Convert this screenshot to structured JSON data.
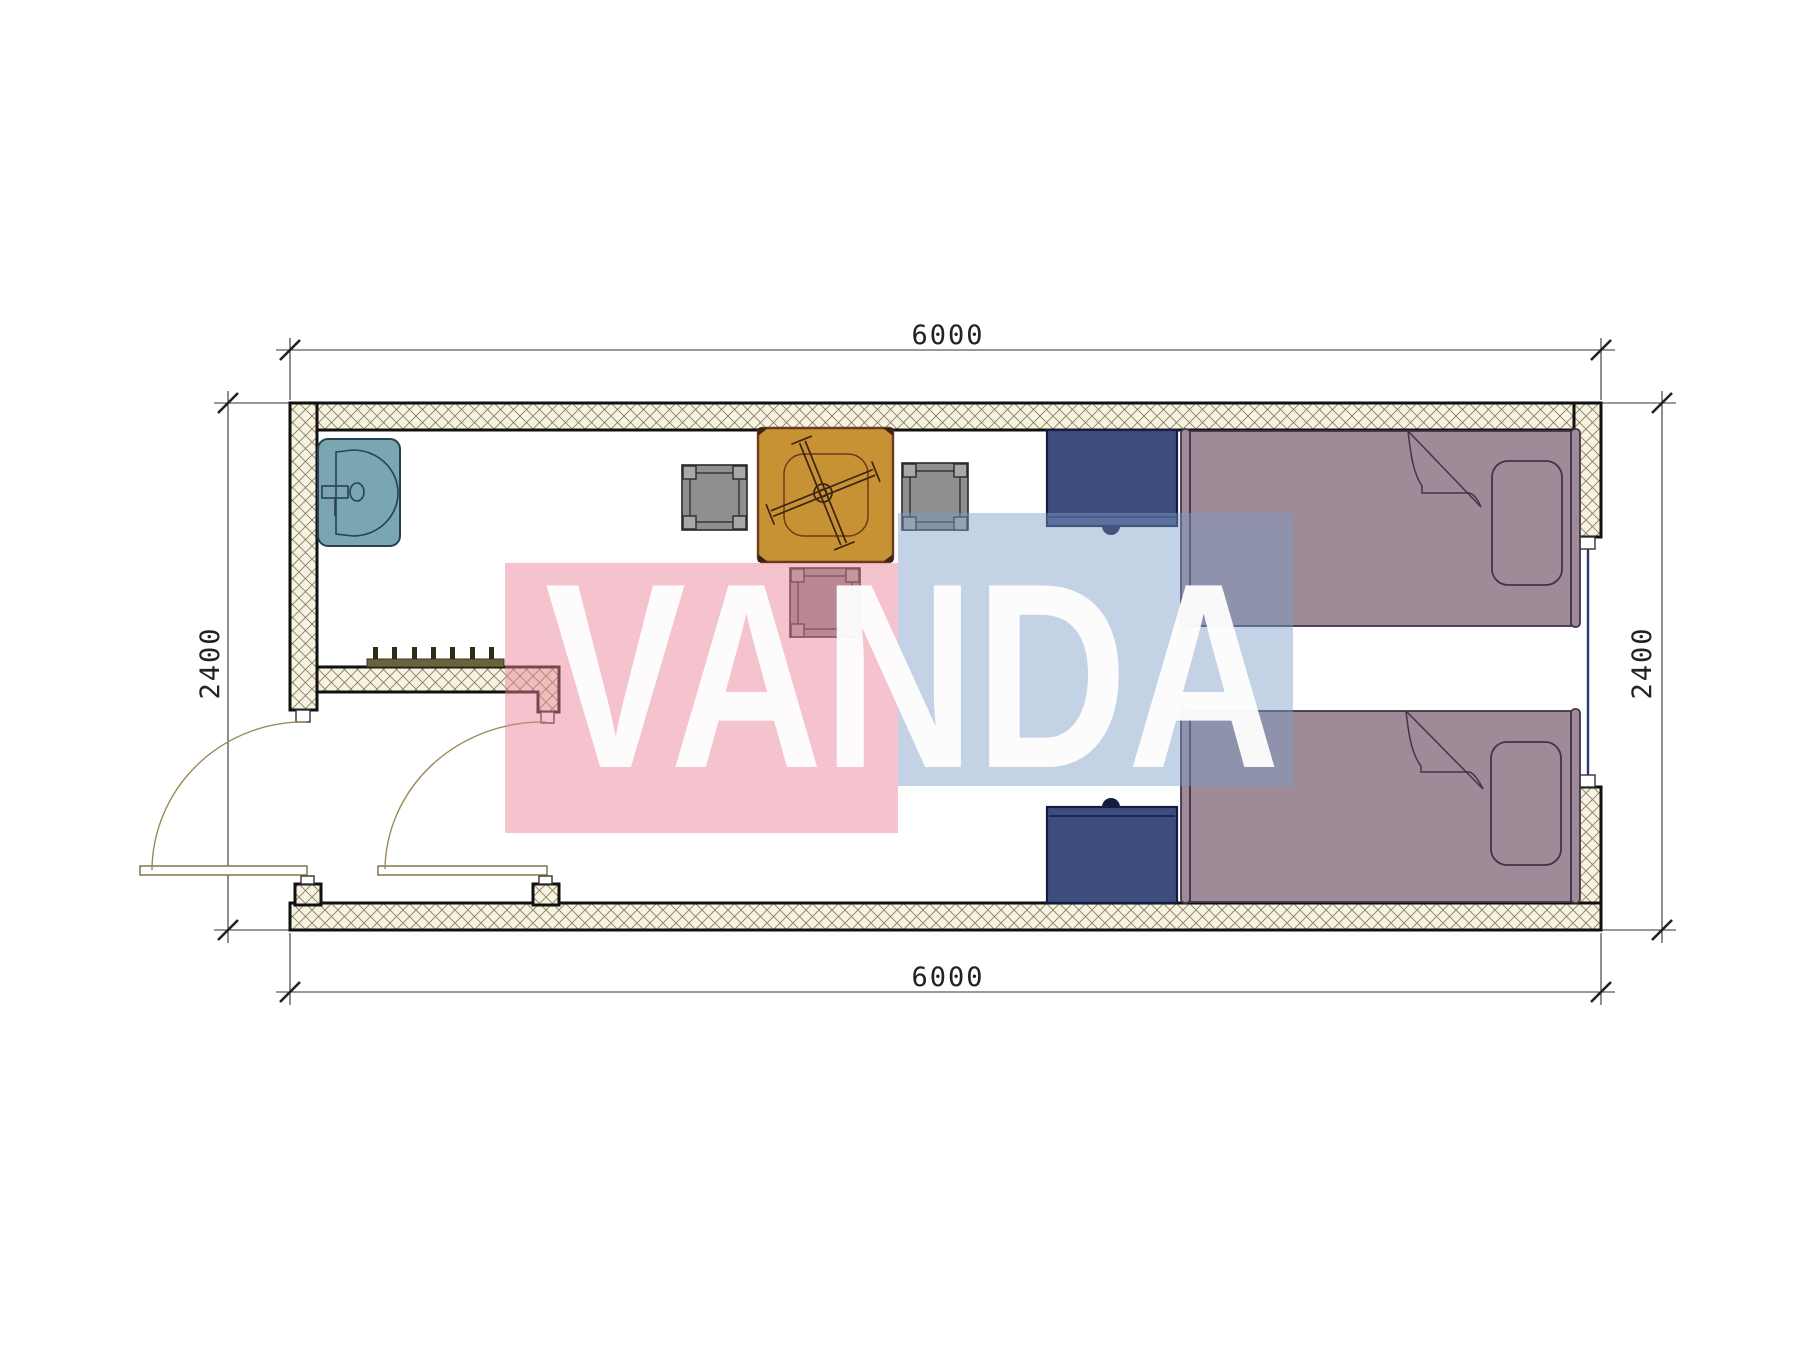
{
  "title": "floor-plan",
  "plan": {
    "type": "room-floor-plan",
    "rooms": [
      "bathroom",
      "bedroom"
    ],
    "furniture_icons": [
      "sink-icon",
      "coat-hooks-icon",
      "square-table-icon",
      "ceiling-fan-symbol-icon",
      "chair-icon",
      "chair-icon",
      "chair-icon",
      "wardrobe-icon",
      "wardrobe-icon",
      "single-bed-icon",
      "single-bed-icon",
      "pillow-icon",
      "pillow-icon",
      "door-swing-icon",
      "door-swing-icon",
      "window-icon"
    ]
  },
  "dimensions": {
    "width_top": "6000",
    "width_bottom": "6000",
    "depth_left": "2400",
    "depth_right": "2400"
  },
  "watermark": {
    "text": "VANDA",
    "pink_color": "rgba(233,130,150,0.48)",
    "blue_color": "rgba(125,155,200,0.45)",
    "text_color": "#ffffff"
  },
  "colors": {
    "wall-fill": "#f7f3e4",
    "wall-line": "#8d7f58",
    "wall-border": "#111111",
    "sink": "#7aa6b1",
    "sink-outline": "#27424e",
    "table": "#c79233",
    "table-outline": "#6d3a20",
    "chair": "#8f8f8f",
    "chair-outline": "#2a2a2a",
    "cabinet": "#3e4d80",
    "cabinet-outline": "#141d3d",
    "bed": "#9f8a97",
    "bed-outline": "#42334c",
    "door": "#9a8a58",
    "dim": "#333333",
    "glass": "#2c3a6e"
  }
}
